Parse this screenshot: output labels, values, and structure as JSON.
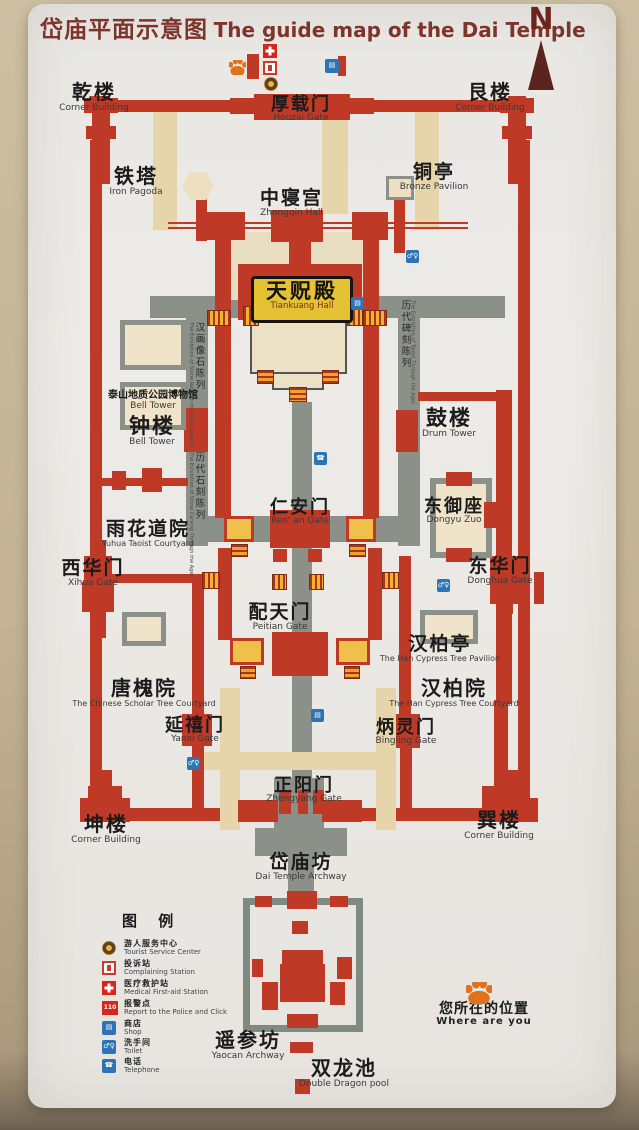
{
  "title": {
    "zh": "岱庙平面示意图",
    "en": "The guide map of the Dai Temple"
  },
  "compass": {
    "n": "N"
  },
  "colors": {
    "map_red": "#bf3927",
    "corridor_gray": "#8b9189",
    "path_beige": "#e6d4ab",
    "sign_yellow": "#e5c134",
    "icon_blue": "#2e74b5",
    "title_red": "#7d352b",
    "board_bg": "#e9e7e3",
    "wall_bg": "#c3b294",
    "paw_orange": "#df731d"
  },
  "places": {
    "qianlou": {
      "zh": "乾楼",
      "en": "Corner Building"
    },
    "houzai": {
      "zh": "厚载门",
      "en": "Houzai Gate"
    },
    "genlou": {
      "zh": "艮楼",
      "en": "Corner Building"
    },
    "tieta": {
      "zh": "铁塔",
      "en": "Iron Pagoda"
    },
    "zhongqin": {
      "zh": "中寝宫",
      "en": "Zhongqin Hall"
    },
    "tongting": {
      "zh": "铜亭",
      "en": "Bronze Pavilion"
    },
    "tiankuang": {
      "zh": "天贶殿",
      "en": "Tiankuang Hall"
    },
    "museum": {
      "zh": "泰山地质公园博物馆",
      "en": "Bell Tower"
    },
    "zhonglou": {
      "zh": "钟楼",
      "en": "Bell Tower"
    },
    "gulou": {
      "zh": "鼓楼",
      "en": "Drum Tower"
    },
    "renan": {
      "zh": "仁安门",
      "en": "Ren' an Gate"
    },
    "dongyuzuo": {
      "zh": "东御座",
      "en": "Dongyu Zuo"
    },
    "yuhua": {
      "zh": "雨花道院",
      "en": "Yuhua Taoist Courtyard"
    },
    "xihua": {
      "zh": "西华门",
      "en": "Xihua Gate"
    },
    "donghua": {
      "zh": "东华门",
      "en": "Donghua Gate"
    },
    "peitian": {
      "zh": "配天门",
      "en": "Peitian Gate"
    },
    "hanbaiting": {
      "zh": "汉柏亭",
      "en": "The Han Cypress Tree Pavilion"
    },
    "tanghuai": {
      "zh": "唐槐院",
      "en": "The Chinese Scholar Tree Courtyard"
    },
    "hanbaiyuan": {
      "zh": "汉柏院",
      "en": "The Han Cypress Tree Courtyard"
    },
    "yanxi": {
      "zh": "延禧门",
      "en": "Yanxi Gate"
    },
    "bingling": {
      "zh": "炳灵门",
      "en": "Bingling Gate"
    },
    "zhengyang": {
      "zh": "正阳门",
      "en": "Zhengyang Gate"
    },
    "kunlou": {
      "zh": "坤楼",
      "en": "Corner Building"
    },
    "xunlou": {
      "zh": "巽楼",
      "en": "Corner Building"
    },
    "daimiaofang": {
      "zh": "岱庙坊",
      "en": "Dai Temple Archway"
    },
    "yaocanfang": {
      "zh": "遥参坊",
      "en": "Yaocan Archway"
    },
    "shuanglongchi": {
      "zh": "双龙池",
      "en": "Double Dragon pool"
    },
    "where": {
      "zh": "您所在的位置",
      "en": "Where are you"
    }
  },
  "exhibitions": {
    "left_upper": {
      "zh": "汉画像石陈列",
      "en": "The Exhibition of Stone Relief in the Han Dynasty"
    },
    "left_lower": {
      "zh": "历代石刻陈列",
      "en": "The Exhibition of Stone Carving Through the Ages"
    },
    "right": {
      "zh": "历代碑刻陈列",
      "en": "The Exhibition of Tablet Through the Ages"
    }
  },
  "legend": {
    "title": "图 例",
    "items": [
      {
        "icon": "tourist-service-badge",
        "zh": "游人服务中心",
        "en": "Tourist Service Center"
      },
      {
        "icon": "complaining-station",
        "zh": "投诉站",
        "en": "Complaining Station"
      },
      {
        "icon": "medical-first-aid",
        "zh": "医疗救护站",
        "en": "Medical First-aid Station"
      },
      {
        "icon": "police-110",
        "zh": "报警点",
        "en": "Report to the Police and Click"
      },
      {
        "icon": "shop",
        "zh": "商店",
        "en": "Shop"
      },
      {
        "icon": "toilet",
        "zh": "洗手间",
        "en": "Toilet"
      },
      {
        "icon": "telephone",
        "zh": "电话",
        "en": "Telephone"
      }
    ]
  },
  "icons": {
    "police_text": "110",
    "phone_glyph": "☎",
    "toilet_glyph": "♂♀",
    "shop_glyph": "▤"
  }
}
